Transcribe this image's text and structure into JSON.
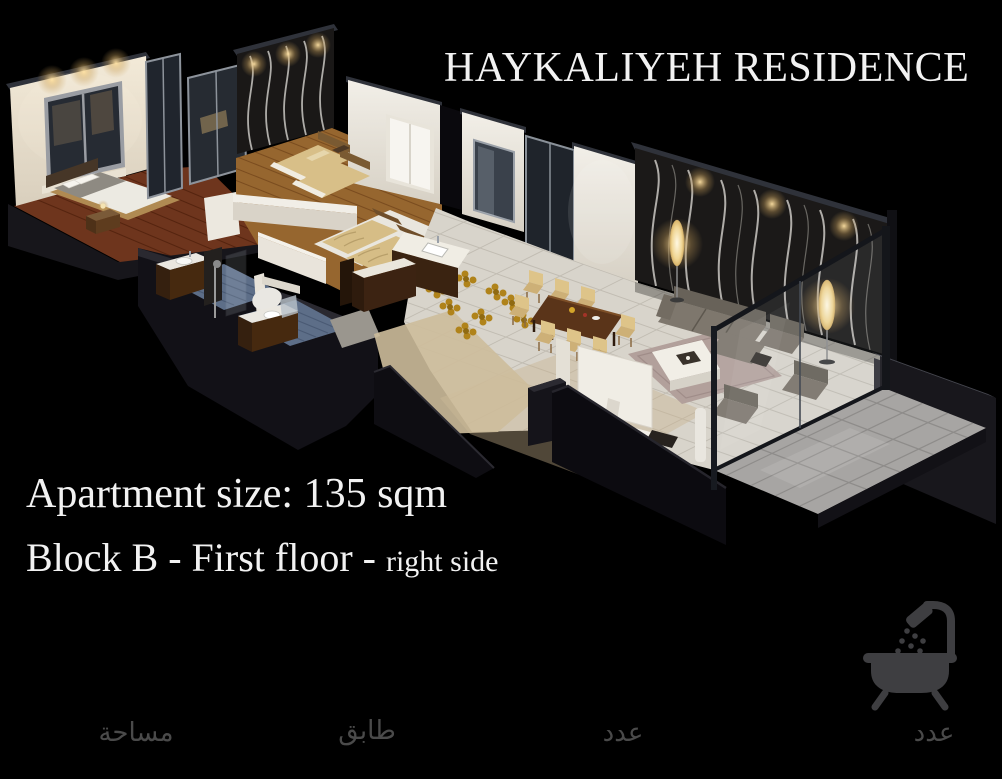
{
  "poster": {
    "title": "HAYKALIYEH RESIDENCE",
    "size_line": "Apartment size: 135 sqm",
    "block_line": "Block B - First floor -",
    "block_line_suffix": "right side"
  },
  "footer": {
    "labels": [
      "مساحة",
      "طابق",
      "عدد",
      "عدد"
    ]
  },
  "scene": {
    "type": "isometric-3d-apartment-render",
    "rooms": [
      "master-bedroom",
      "twin-bedroom",
      "twin-bedroom-2",
      "bathrooms",
      "kitchen",
      "dining-area",
      "living-room",
      "balcony"
    ],
    "colors": {
      "background": "#000000",
      "headline_text": "#f2f2f2",
      "footer_text": "#4a4a4a",
      "bathtub_icon": "#3e3e41",
      "feature_wallpaper": "#1b1918",
      "wallpaper_waves": "#c9c7c2",
      "cream_walls": "#ece2d0",
      "master_wood_floor": "#6e351d",
      "bedroom_wood_floor": "#96662f",
      "tile_floor": "#d8d4cb",
      "gold_rug": "#b0831a",
      "sofa_gray": "#7e776d",
      "bathroom_tile_blue": "#5d6e88",
      "lamp_glow": "#f6e3b4"
    }
  }
}
